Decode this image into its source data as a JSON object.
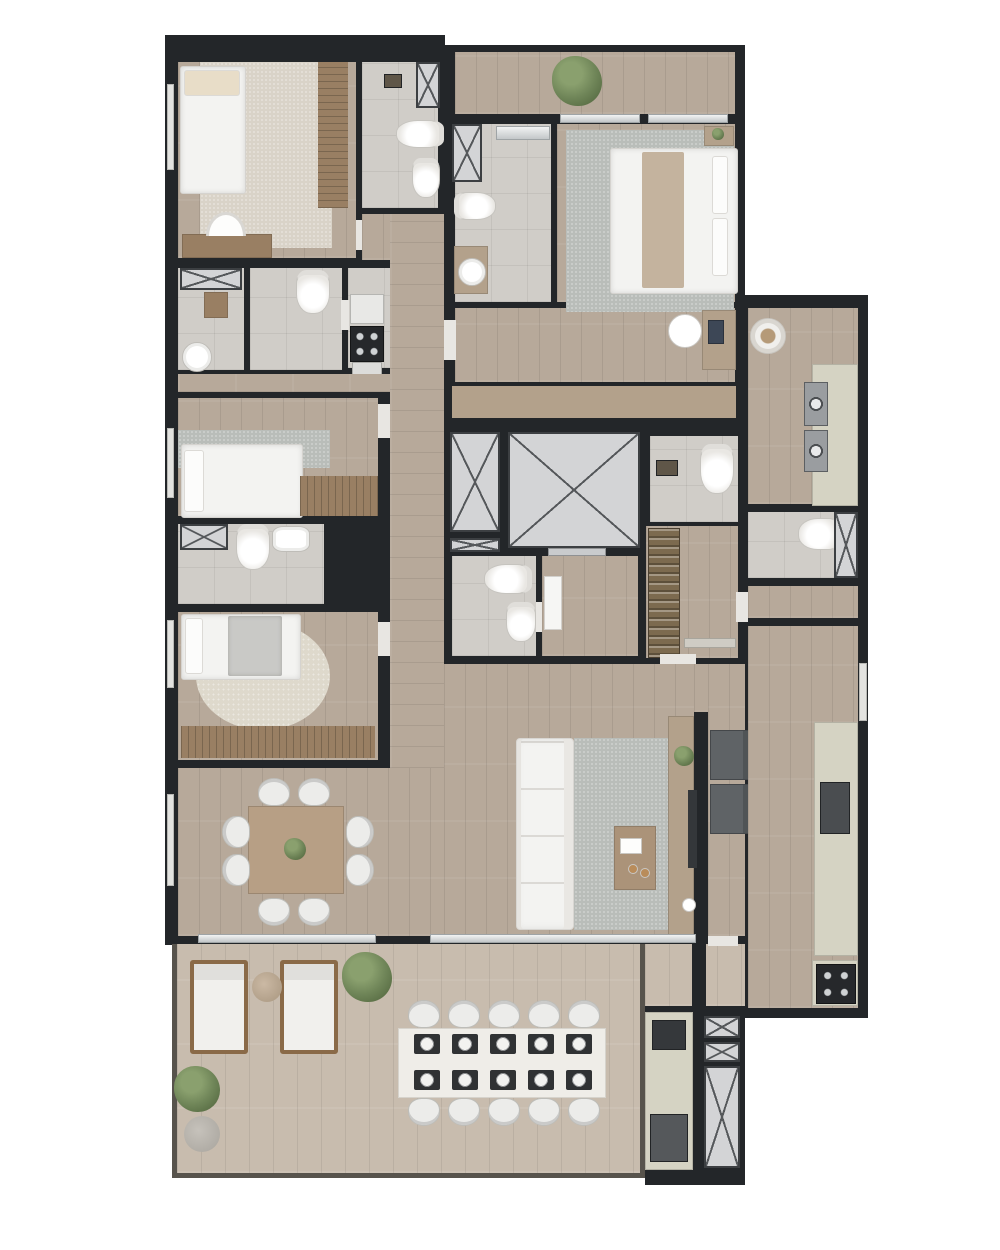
{
  "palette": {
    "background": "#ffffff",
    "wall": "#232629",
    "wood_floor": "#b7a99a",
    "wood_floor_light": "#c8bcae",
    "tile_floor": "#d0cdc8",
    "shaft_fill": "#d3d4d6",
    "shaft_line": "#55585b",
    "rug_gray": "#b9bdb9",
    "rug_beige": "#d9d3c8",
    "rug_cream": "#ded9cc",
    "furniture_white": "#f3f3f1",
    "furniture_brown": "#997f63",
    "furniture_tan": "#b3a18b",
    "counter_sage": "#d5d3c3",
    "appliance_dark": "#35383b",
    "armchair_gray": "#5f6366",
    "plant_green": "#6f8558",
    "lounger_wood": "#8a6a48",
    "glass": "#c3c7c9"
  },
  "scene": {
    "type": "apartment-floor-plan-top-view",
    "rooms": [
      "top-balcony",
      "bedroom-1",
      "bathroom-1",
      "service-bathroom-a",
      "service-bathroom-b",
      "kitchenette",
      "hallway",
      "bedroom-2",
      "bathroom-2",
      "bedroom-3",
      "master-bathroom",
      "master-bedroom",
      "dressing-area",
      "elevator-core",
      "hall-bathroom",
      "entry-vestibule",
      "wine-cellar",
      "powder-room",
      "laundry-corridor",
      "laundry-bathroom",
      "kitchen",
      "living-room",
      "dining-room",
      "terrace"
    ],
    "counts": {
      "beds": 4,
      "toilets": 7,
      "bidets": 3,
      "elevator_shafts": 2,
      "duct_shafts": 9,
      "dining_chairs": 8,
      "terrace_dining_chairs": 10,
      "terrace_place_settings": 10,
      "sun_loungers": 2,
      "washing_machines": 2,
      "armchairs": 2,
      "stove_burners": 4,
      "cooktop_burners": 4,
      "plants": 6
    },
    "furniture": [
      "double-bed",
      "single-bed",
      "wardrobe",
      "desk",
      "desk-chair",
      "sofa",
      "rug",
      "coffee-table",
      "tv",
      "tv-console",
      "armchair",
      "dining-table",
      "planter",
      "terrace-dining-table",
      "place-setting",
      "sun-lounger",
      "side-table",
      "washing-machine",
      "laundry-counter",
      "kitchen-island",
      "sink",
      "stove",
      "cooktop",
      "fridge",
      "grill",
      "wine-rack",
      "toilet",
      "bidet",
      "vanity",
      "shower",
      "bench",
      "pouf",
      "stone-ottoman"
    ]
  }
}
